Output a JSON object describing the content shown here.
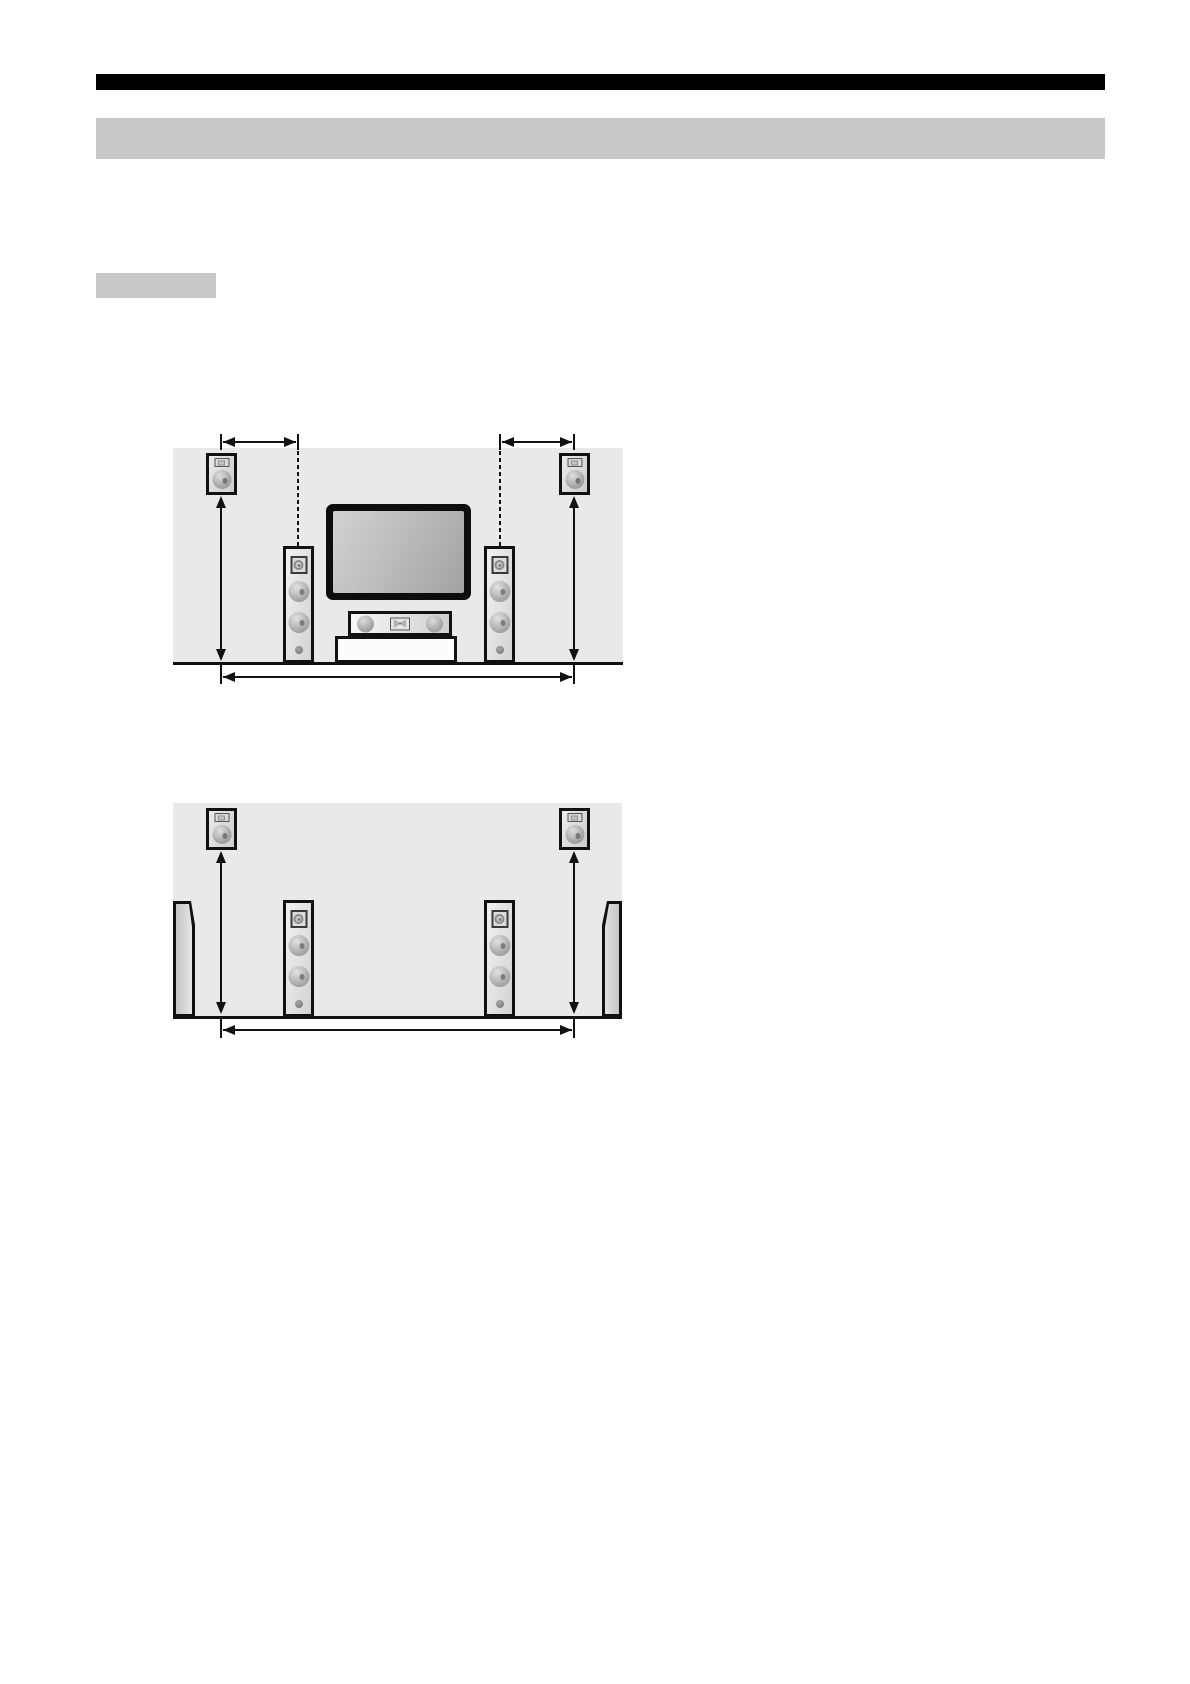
{
  "document": {
    "kind": "speaker-placement-instruction-page",
    "visible_text": "none (title bars and labels appear as solid blocks)"
  },
  "colors": {
    "page_bg": "#ffffff",
    "bar_black": "#000000",
    "bar_gray": "#c9c9c9",
    "panel_bg": "#e9e9e9",
    "line": "#111111"
  },
  "header": {
    "bars": [
      {
        "name": "top-rule-bar",
        "style": "black",
        "x": 96,
        "y": 74,
        "w": 1009,
        "h": 16
      },
      {
        "name": "section-title-bar",
        "style": "gray",
        "x": 96,
        "y": 118,
        "w": 1009,
        "h": 41
      },
      {
        "name": "subsection-label-box",
        "style": "gray",
        "x": 96,
        "y": 273,
        "w": 120,
        "h": 25
      }
    ]
  },
  "component_sizes": {
    "satellite": {
      "w": 31,
      "h": 42
    },
    "tower": {
      "w": 31,
      "h": 117
    },
    "tv": {
      "w": 145,
      "h": 96
    },
    "center": {
      "w": 104,
      "h": 25
    },
    "stand": {
      "w": 122,
      "h": 27
    },
    "wall": {
      "w": 22,
      "h": 116
    }
  },
  "figures": [
    {
      "name": "figure-front-placement",
      "description": "front speaker layout with TV, center speaker and stand",
      "panel": {
        "x": 173,
        "y": 448,
        "w": 450,
        "h": 217
      },
      "floor": {
        "x": 173,
        "y": 662,
        "w": 450,
        "h": 3
      },
      "components": [
        {
          "type": "satellite",
          "name": "surround-speaker-left",
          "x": 206,
          "y": 453
        },
        {
          "type": "satellite",
          "name": "surround-speaker-right",
          "x": 559,
          "y": 453
        },
        {
          "type": "tower",
          "name": "front-tower-speaker-left",
          "x": 283,
          "y": 546
        },
        {
          "type": "tower",
          "name": "front-tower-speaker-right",
          "x": 484,
          "y": 546
        },
        {
          "type": "tv",
          "name": "tv-display",
          "x": 326,
          "y": 504
        },
        {
          "type": "center",
          "name": "center-speaker",
          "x": 348,
          "y": 611
        },
        {
          "type": "stand",
          "name": "tv-stand",
          "x": 335,
          "y": 636
        }
      ],
      "annotations": [
        {
          "type": "hdim",
          "name": "top-left-distance-arrow",
          "x1": 221,
          "x2": 298,
          "y": 442,
          "endTicks": true
        },
        {
          "type": "hdim",
          "name": "top-right-distance-arrow",
          "x1": 500,
          "x2": 574,
          "y": 442,
          "endTicks": true
        },
        {
          "type": "dash",
          "name": "guide-line-left",
          "x": 298,
          "y1": 444,
          "y2": 546
        },
        {
          "type": "dash",
          "name": "guide-line-right",
          "x": 500,
          "y1": 444,
          "y2": 546
        },
        {
          "type": "vdim",
          "name": "height-arrow-left",
          "x": 221,
          "y1": 496,
          "y2": 661
        },
        {
          "type": "vdim",
          "name": "height-arrow-right",
          "x": 574,
          "y1": 496,
          "y2": 661
        },
        {
          "type": "tick",
          "name": "bottom-tick-left",
          "x": 221,
          "y1": 662,
          "y2": 684
        },
        {
          "type": "tick",
          "name": "bottom-tick-right",
          "x": 574,
          "y1": 662,
          "y2": 684
        },
        {
          "type": "hdim",
          "name": "bottom-width-arrow",
          "x1": 221,
          "x2": 574,
          "y": 677,
          "endTicks": false
        }
      ]
    },
    {
      "name": "figure-surround-placement",
      "description": "surround speaker layout with side walls",
      "panel": {
        "x": 173,
        "y": 803,
        "w": 449,
        "h": 216
      },
      "floor": {
        "x": 173,
        "y": 1016,
        "w": 449,
        "h": 3
      },
      "components": [
        {
          "type": "satellite",
          "name": "surround-speaker-left",
          "x": 206,
          "y": 808
        },
        {
          "type": "satellite",
          "name": "surround-speaker-right",
          "x": 559,
          "y": 808
        },
        {
          "type": "tower",
          "name": "front-tower-speaker-left",
          "x": 283,
          "y": 900
        },
        {
          "type": "tower",
          "name": "front-tower-speaker-right",
          "x": 484,
          "y": 900
        },
        {
          "type": "wall",
          "name": "wall-segment-left",
          "x": 173,
          "y": 901,
          "side": "left"
        },
        {
          "type": "wall",
          "name": "wall-segment-right",
          "x": 600,
          "y": 901,
          "side": "right"
        }
      ],
      "annotations": [
        {
          "type": "vdim",
          "name": "height-arrow-left",
          "x": 221,
          "y1": 851,
          "y2": 1014
        },
        {
          "type": "vdim",
          "name": "height-arrow-right",
          "x": 574,
          "y1": 851,
          "y2": 1014
        },
        {
          "type": "tick",
          "name": "bottom-tick-left",
          "x": 221,
          "y1": 1016,
          "y2": 1038
        },
        {
          "type": "tick",
          "name": "bottom-tick-right",
          "x": 574,
          "y1": 1016,
          "y2": 1038
        },
        {
          "type": "hdim",
          "name": "bottom-width-arrow",
          "x1": 221,
          "x2": 574,
          "y": 1030,
          "endTicks": false
        }
      ]
    }
  ]
}
